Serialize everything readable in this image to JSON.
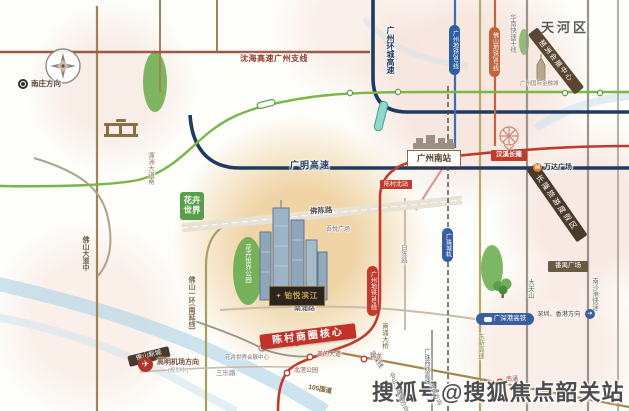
{
  "watermark": "搜狐号@搜狐焦点韶关站",
  "district": "天河区",
  "project": {
    "name": "铂悦滨江",
    "banner": "陈村商圈核心"
  },
  "highways": {
    "shenhai": "沈海高速广州支线",
    "huancheng": "广州环城高速",
    "guangming": "广明高速",
    "huanan": "华南快速干线",
    "nanshagang": "南沙港快速",
    "dongxin": "东新高速",
    "guangzhuxi": "广珠西线高速",
    "g105": "105国道",
    "jingzhu": "京珠线",
    "yihuan": "佛山一环(南延线)"
  },
  "roads": {
    "fochen": "佛陈路",
    "nanchong": "南涌路",
    "sanle": "三乐路",
    "baichen": "白陈路",
    "foshandadao": "佛山大道中",
    "tanzhou": "潭洲大道南",
    "nanchongbridge": "南涌大桥"
  },
  "rail": {
    "station": "广州南站",
    "hsr": "广深港高铁",
    "intercity": "广珠城轨",
    "chencun_intercity": "城轨陈村站",
    "gz_line7": "广州地铁7号线",
    "gz_line2": "广州地铁2号线",
    "fs_line2": "佛山地铁2号线",
    "to_shenzhen": "深圳、香港方向"
  },
  "stations": {
    "hanxichanglong": "汉溪长隆",
    "chencunbei": "陈村北站",
    "meididadao": "美的大道",
    "beijiaopark": "北滘公园",
    "jinlong": "锦龙",
    "nanchong": "南涌"
  },
  "landmarks": {
    "changlong": "长隆旅游度假区",
    "wanda": "万达广场",
    "pazhou": "琶洲会展中心",
    "financecity": "广州国际金融城",
    "panyusquare": "番禺广场",
    "huahui": "花卉世界",
    "huahuipark": "花卉世界公园",
    "huahuiexpo": "花卉世界会展中心",
    "wuyue": "吾悦广场",
    "dafushan": "大夫山",
    "fsnewtown": "佛山新城"
  },
  "directions": {
    "nanzhuang": "南庄方向",
    "airport": "高明机场方向",
    "airport_note": "(规划中)",
    "zhongshanzhuhai": "中山、珠海方向",
    "daliang": "大良方向"
  },
  "icons": {
    "plane": "✈",
    "metro_m": "M",
    "arrow": "➔",
    "logo_diamond": "✦"
  },
  "colors": {
    "metro_red": "#c13a2e",
    "highway_navy": "#1f3b61",
    "metro_green": "#7ab648",
    "badge_brown": "#4a3a2b",
    "banner_red": "#c13328"
  }
}
